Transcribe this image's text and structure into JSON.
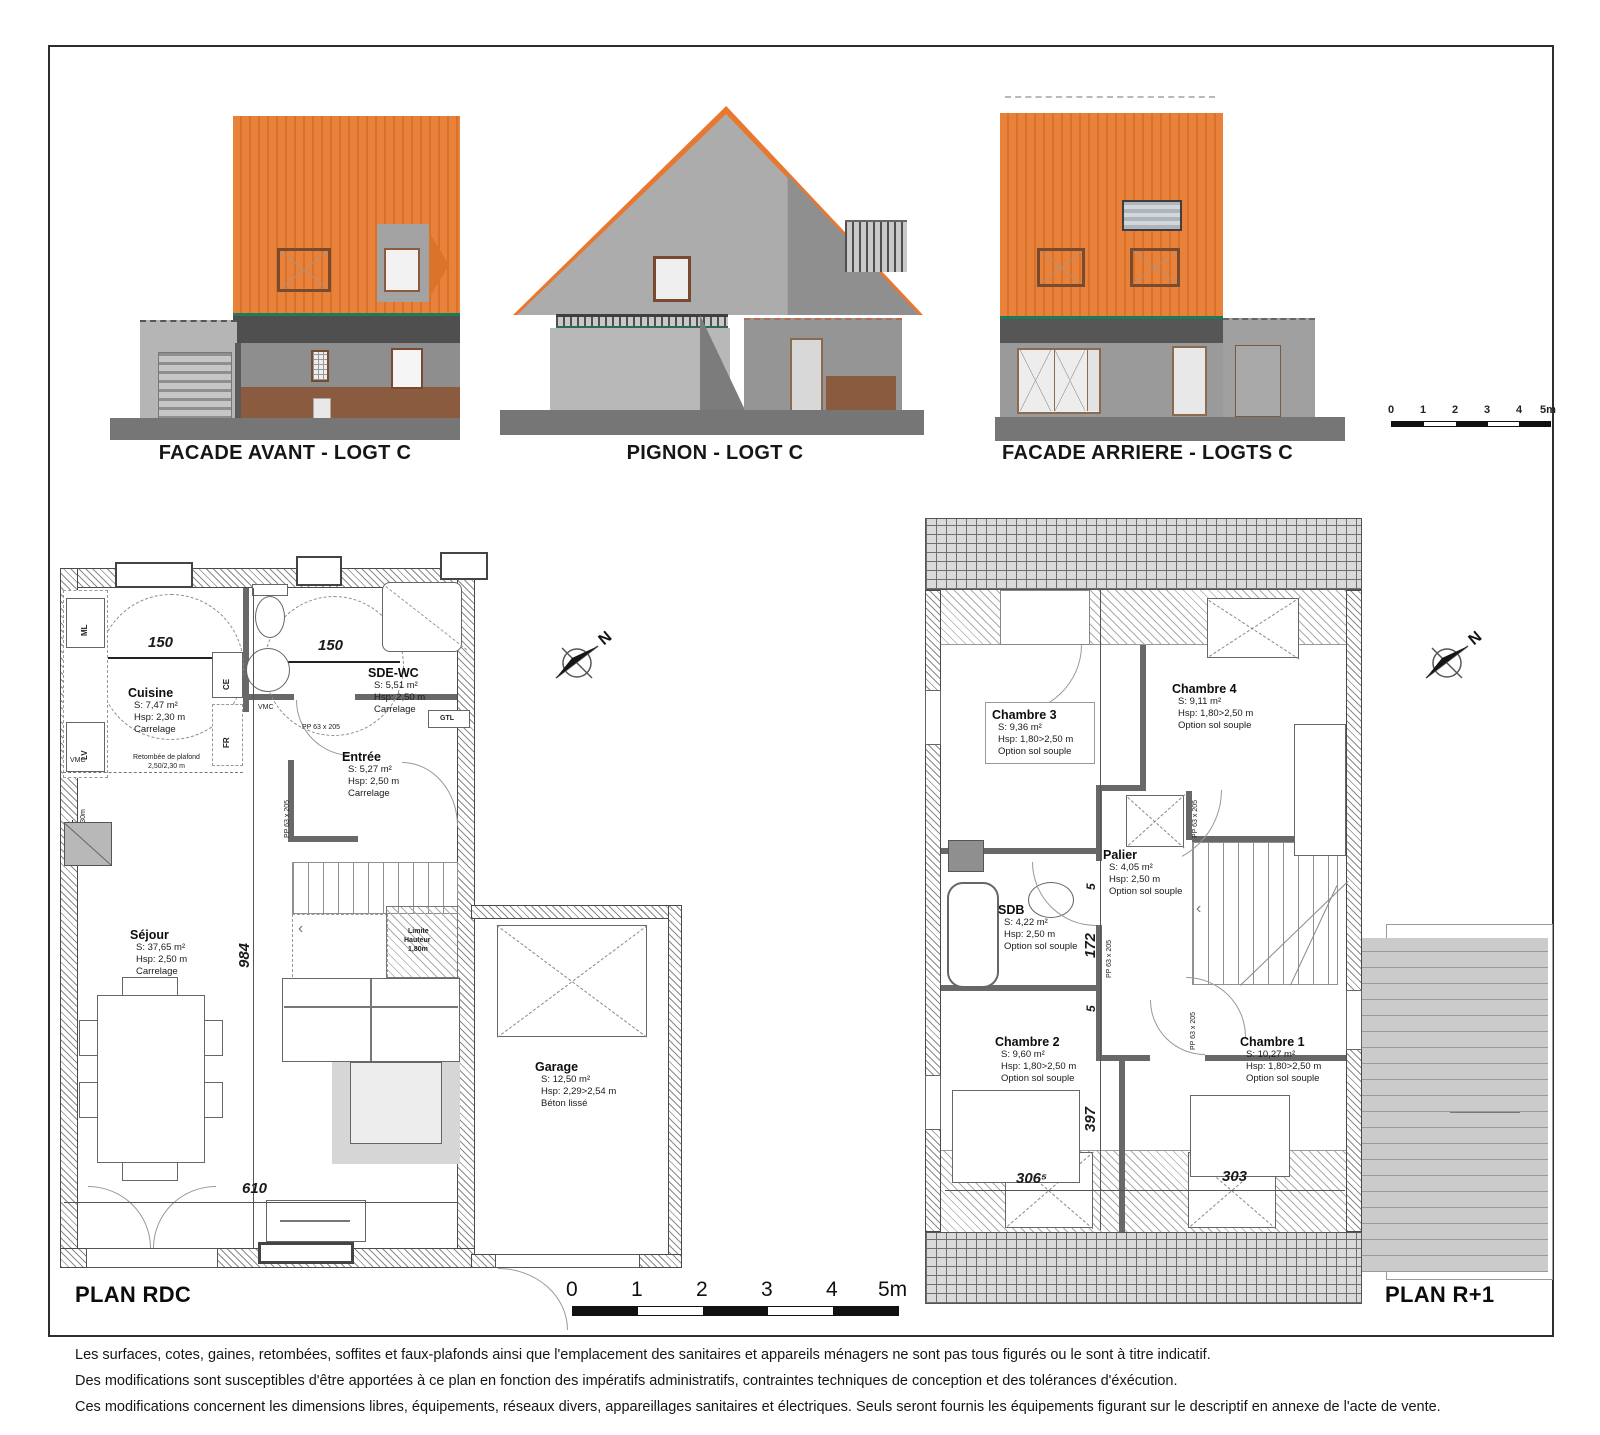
{
  "doc": {
    "facades": [
      {
        "label": "FACADE AVANT - LOGT C"
      },
      {
        "label": "PIGNON - LOGT C"
      },
      {
        "label": "FACADE ARRIERE - LOGTS C"
      }
    ],
    "scale": {
      "ticks": [
        "0",
        "1",
        "2",
        "3",
        "4",
        "5m"
      ]
    },
    "compass": {
      "label": "N"
    },
    "plans": {
      "rdc": {
        "title": "PLAN RDC",
        "rooms": {
          "cuisine": {
            "name": "Cuisine",
            "area": "S: 7,47 m²",
            "hsp": "Hsp: 2,30 m",
            "floor": "Carrelage"
          },
          "sde": {
            "name": "SDE-WC",
            "area": "S: 5,51 m²",
            "hsp": "Hsp: 2,50 m",
            "floor": "Carrelage"
          },
          "entree": {
            "name": "Entrée",
            "area": "S: 5,27 m²",
            "hsp": "Hsp: 2,50 m",
            "floor": "Carrelage"
          },
          "sejour": {
            "name": "Séjour",
            "area": "S: 37,65 m²",
            "hsp": "Hsp: 2,50 m",
            "floor": "Carrelage"
          },
          "garage": {
            "name": "Garage",
            "area": "S: 12,50 m²",
            "hsp": "Hsp: 2,29>2,54 m",
            "floor": "Béton lissé"
          }
        },
        "dims": {
          "w150a": "150",
          "w150b": "150",
          "h984": "984",
          "w610": "610"
        },
        "labels": {
          "ml": "ML",
          "lv": "LV",
          "fr": "FR",
          "ce": "CE",
          "gtl": "GTL",
          "pl": "PL",
          "pl_hsp": "Hsp: 2,30m",
          "vmc": "VMC",
          "retombee": "Retombée de plafond",
          "retombee2": "2,50/2,30 m",
          "limite1": "Limite",
          "limite2": "Hauteur",
          "limite3": "1,80m",
          "pp": "PP 63 x 205"
        }
      },
      "r1": {
        "title": "PLAN R+1",
        "rooms": {
          "ch3": {
            "name": "Chambre 3",
            "area": "S: 9,36 m²",
            "hsp": "Hsp: 1,80>2,50 m",
            "floor": "Option sol souple"
          },
          "ch4": {
            "name": "Chambre 4",
            "area": "S: 9,11 m²",
            "hsp": "Hsp: 1,80>2,50 m",
            "floor": "Option sol souple"
          },
          "palier": {
            "name": "Palier",
            "area": "S: 4,05 m²",
            "hsp": "Hsp: 2,50 m",
            "floor": "Option sol souple"
          },
          "sdb": {
            "name": "SDB",
            "area": "S: 4,22 m²",
            "hsp": "Hsp: 2,50 m",
            "floor": "Option sol souple"
          },
          "ch2": {
            "name": "Chambre 2",
            "area": "S: 9,60 m²",
            "hsp": "Hsp: 1,80>2,50 m",
            "floor": "Option sol souple"
          },
          "ch1": {
            "name": "Chambre 1",
            "area": "S: 10,27 m²",
            "hsp": "Hsp: 1,80>2,50 m",
            "floor": "Option sol souple"
          }
        },
        "dims": {
          "d405": "405",
          "d172": "172",
          "d397": "397",
          "d5a": "5",
          "d5b": "5",
          "d306": "306⁵",
          "d303": "303"
        },
        "labels": {
          "pp": "PP 63 x 205"
        }
      }
    },
    "footer": {
      "line1": "Les surfaces, cotes, gaines, retombées, soffites et faux-plafonds ainsi que l'emplacement des sanitaires et appareils ménagers ne sont pas tous figurés ou le sont à titre indicatif.",
      "line2": "Des modifications sont susceptibles d'être apportées à ce plan en fonction des impératifs administratifs, contraintes techniques de conception et des tolérances d'éxécution.",
      "line3": "Ces modifications concernent les dimensions libres, équipements, réseaux divers, appareillages sanitaires et électriques. Seuls seront fournis les équipements figurant sur le descriptif en annexe de l'acte de vente."
    }
  }
}
